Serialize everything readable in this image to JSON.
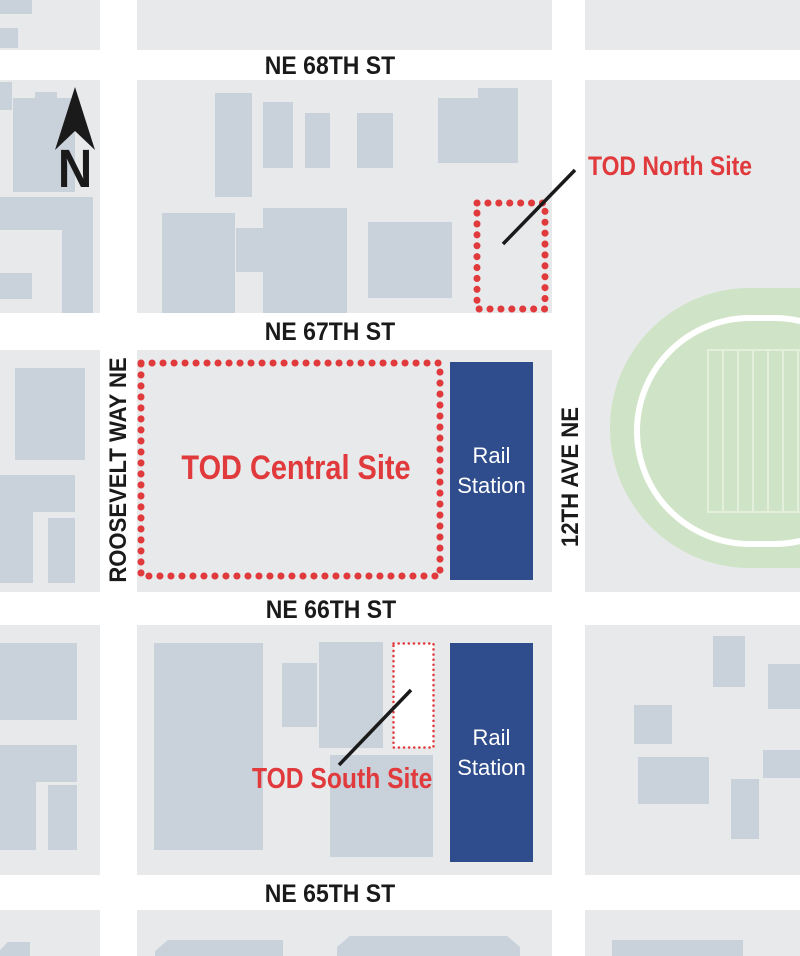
{
  "map_title": "TOD sites location map",
  "compass": {
    "north_label": "N"
  },
  "streets": {
    "ne_68th": "NE 68TH ST",
    "ne_67th": "NE 67TH ST",
    "ne_66th": "NE 66TH ST",
    "ne_65th": "NE 65TH ST",
    "roosevelt": "ROOSEVELT WAY NE",
    "twelfth_ave": "12TH AVE NE"
  },
  "sites": {
    "north": {
      "label": "TOD North Site"
    },
    "central": {
      "label": "TOD Central Site"
    },
    "south": {
      "label": "TOD South Site"
    }
  },
  "stations": [
    {
      "line1": "Rail",
      "line2": "Station"
    },
    {
      "line1": "Rail",
      "line2": "Station"
    }
  ],
  "colors": {
    "accent_red": "#e03a3c",
    "station_blue": "#2f4d8c",
    "block_gray": "#e8e9eb",
    "building_gray": "#c9d1da",
    "field_green": "#cfe3c6",
    "field_line_green": "#e4efdb",
    "street_white": "#ffffff",
    "label_black": "#1a1a1a"
  }
}
